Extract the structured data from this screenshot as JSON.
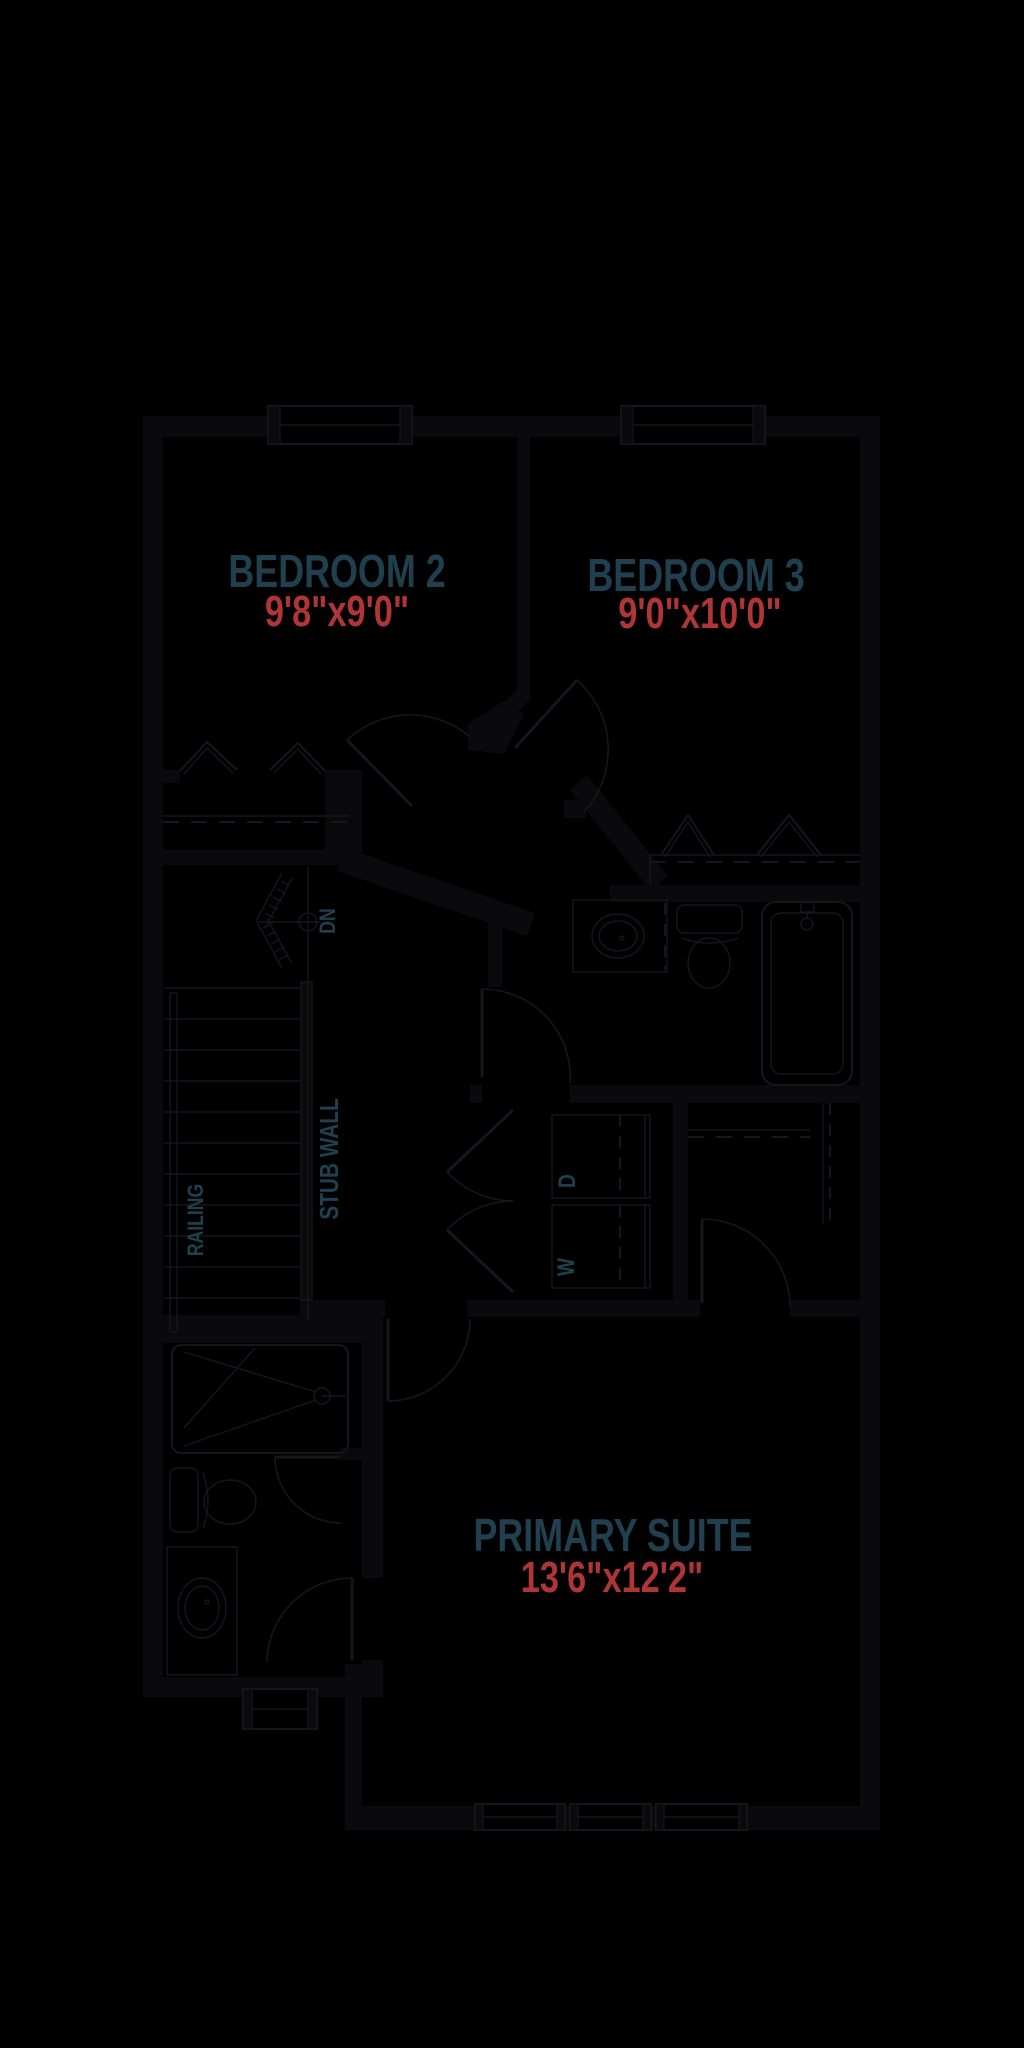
{
  "plan": {
    "title": "second-floor-plan",
    "rooms": [
      {
        "name": "BEDROOM 2",
        "dims": "9'8\"x9'0\""
      },
      {
        "name": "BEDROOM 3",
        "dims": "9'0\"x10'0\""
      },
      {
        "name": "PRIMARY SUITE",
        "dims": "13'6\"x12'2\""
      }
    ],
    "annotations": {
      "down": "DN",
      "stub_wall": "STUB WALL",
      "railing": "RAILING",
      "washer": "W",
      "dryer": "D"
    },
    "colors": {
      "background": "#000000",
      "wall": "#0a0a0d",
      "line": "#16161c",
      "room_label": "#20404f",
      "dimension_label": "#b03537"
    }
  }
}
